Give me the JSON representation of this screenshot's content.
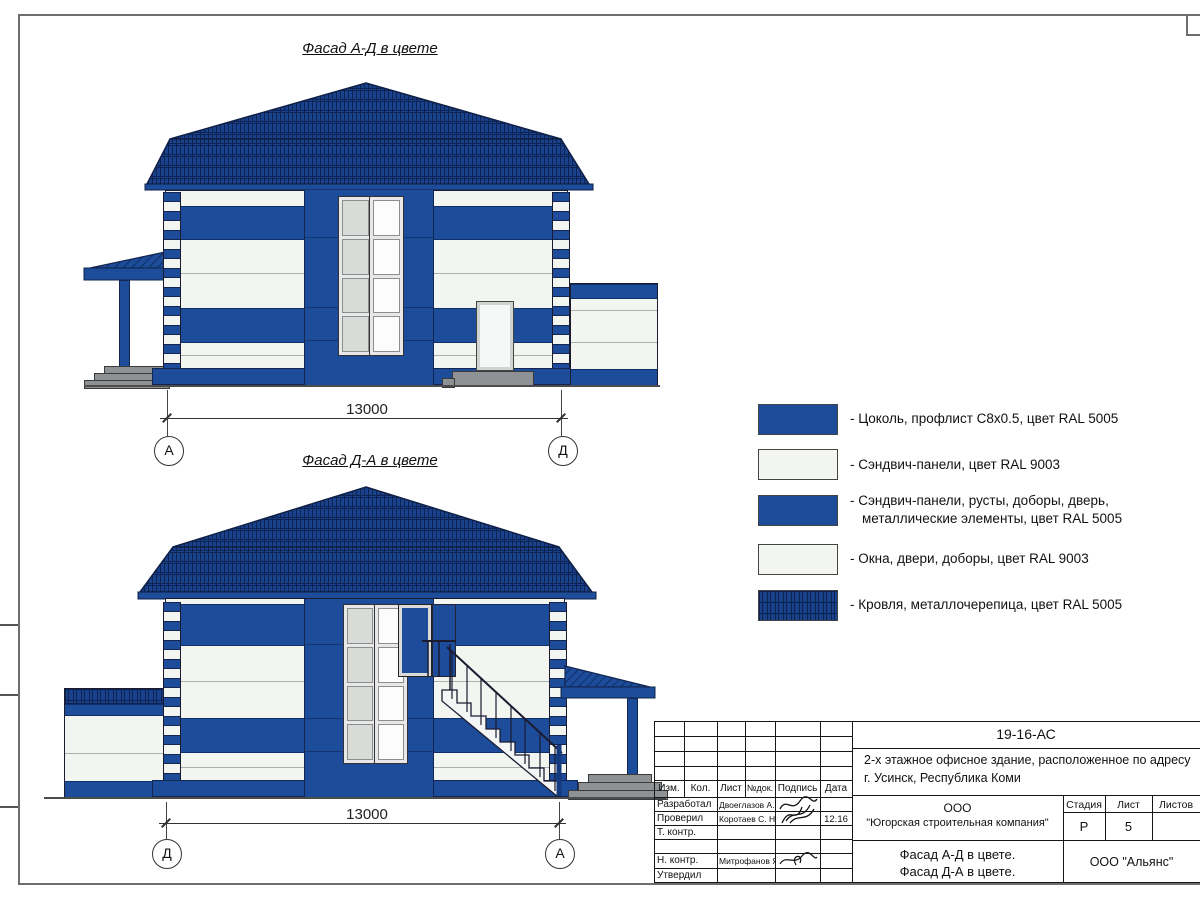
{
  "drawing": {
    "facade_top": {
      "title": "Фасад А-Д в цвете",
      "dimension": "13000",
      "axis_left": "А",
      "axis_right": "Д"
    },
    "facade_bottom": {
      "title": "Фасад Д-А в цвете",
      "dimension": "13000",
      "axis_left": "Д",
      "axis_right": "А"
    }
  },
  "legend": {
    "items": [
      {
        "swatch": "ral5005-solid",
        "line1": "- Цоколь, профлист С8х0.5, цвет RAL 5005"
      },
      {
        "swatch": "ral9003-solid",
        "line1": "- Сэндвич-панели, цвет RAL 9003"
      },
      {
        "swatch": "ral5005-solid",
        "line1": "- Сэндвич-панели, русты, доборы, дверь,",
        "line2": "металлические элементы, цвет RAL 5005"
      },
      {
        "swatch": "ral9003-solid",
        "line1": "- Окна, двери, доборы, цвет RAL 9003"
      },
      {
        "swatch": "roof-tile",
        "line1": "- Кровля, металлочерепица, цвет RAL 5005"
      }
    ]
  },
  "titleblock": {
    "code": "19-16-АС",
    "project_line1": "2-х этажное офисное здание, расположенное по адресу",
    "project_line2": "г. Усинск, Республика Коми",
    "columns": [
      "Изм.",
      "Кол.",
      "Лист",
      "№док.",
      "Подпись",
      "Дата"
    ],
    "rows": [
      {
        "role": "Разработал",
        "name": "Двоеглазов А. В.",
        "date": ""
      },
      {
        "role": "Проверил",
        "name": "Коротаев С. Н.",
        "date": "12.16"
      },
      {
        "role": "Т. контр.",
        "name": "",
        "date": ""
      },
      {
        "role": "",
        "name": "",
        "date": ""
      },
      {
        "role": "Н. контр.",
        "name": "Митрофанов Я. А.",
        "date": ""
      },
      {
        "role": "Утвердил",
        "name": "",
        "date": ""
      }
    ],
    "company_line1": "ООО",
    "company_line2": "\"Югорская строительная компания\"",
    "stage_label": "Стадия",
    "sheet_label": "Лист",
    "sheets_label": "Листов",
    "stage": "Р",
    "sheet": "5",
    "sheet_name_line1": "Фасад А-Д в цвете.",
    "sheet_name_line2": "Фасад Д-А в цвете.",
    "org": "ООО \"Альянс\""
  },
  "colors": {
    "ral5005_blue": "#1c4c9a",
    "roof_blue": "#1a428c",
    "ral9003_white": "#f3f5f1"
  }
}
